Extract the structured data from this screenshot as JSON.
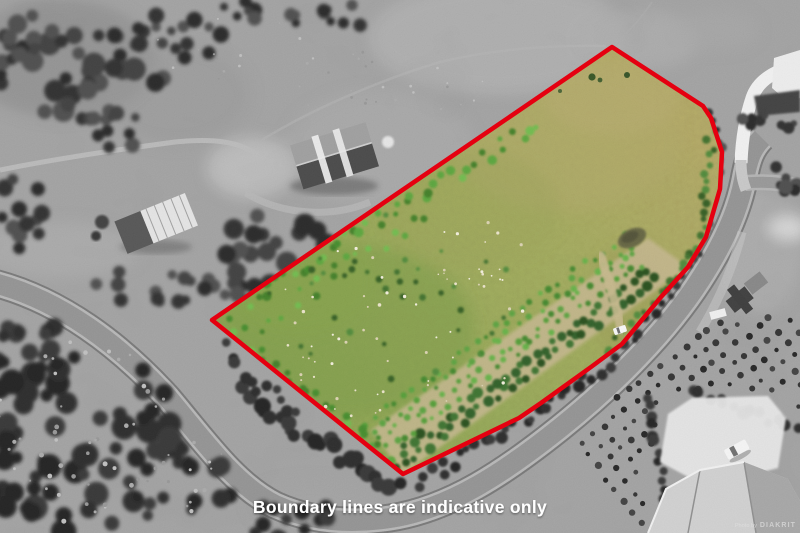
{
  "overlay": {
    "caption": "Boundary lines are indicative only",
    "watermark_prefix": "Photo by",
    "watermark_brand": "DIAKRIT"
  },
  "boundary": {
    "points": "612,47 703,106 711,118 722,152 720,189 706,237 688,267 661,297 622,344 591,367 541,403 519,418 403,474 212,320",
    "color": "#e50010",
    "stroke_width": 4.5
  },
  "palette": {
    "background_gray": "#9a9a9a",
    "road_gray": "#969696",
    "tree_dark_gray": "#2c2c2c",
    "pasture_green": "#8ea34e",
    "pasture_olive": "#a89e58",
    "shrub_green": "#55a237",
    "dirt_tan": "#c6b78e",
    "caption_white": "#ffffff"
  }
}
